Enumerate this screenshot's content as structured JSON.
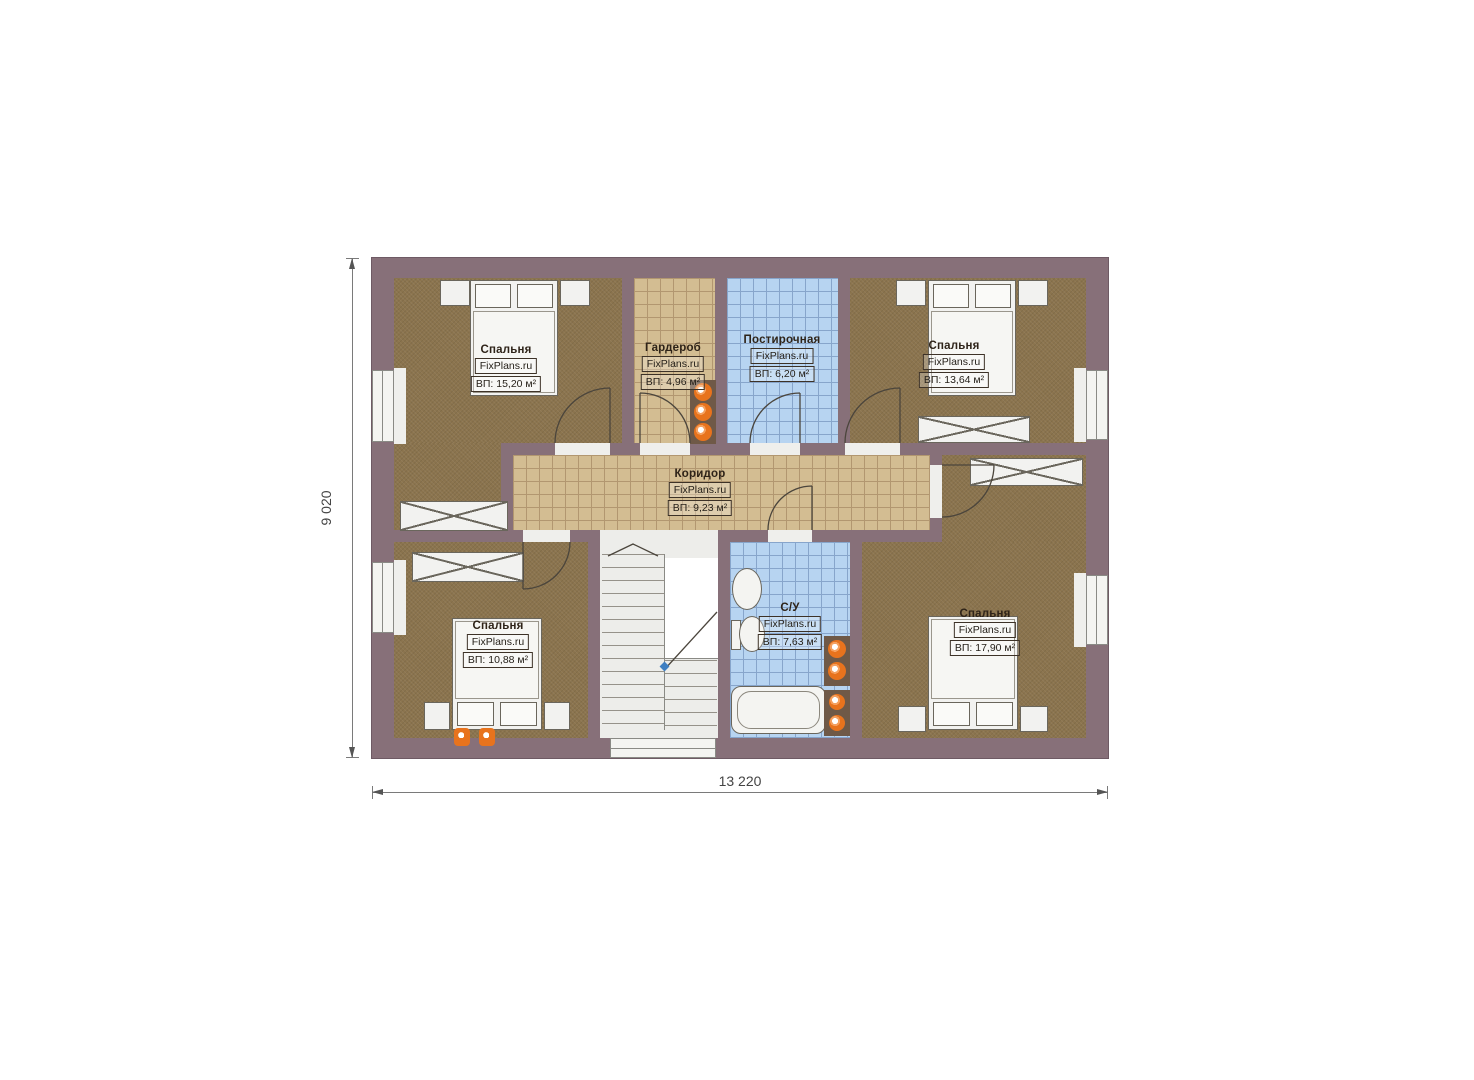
{
  "plan": {
    "watermark": "FixPlans.ru",
    "dimensions": {
      "width": "13 220",
      "height": "9 020"
    },
    "rooms": [
      {
        "key": "bedroom-top-left",
        "name": "Спальня",
        "area": "ВП: 15,20 м²"
      },
      {
        "key": "wardrobe",
        "name": "Гардероб",
        "area": "ВП: 4,96 м²"
      },
      {
        "key": "laundry",
        "name": "Постирочная",
        "area": "ВП: 6,20 м²"
      },
      {
        "key": "bedroom-top-right",
        "name": "Спальня",
        "area": "ВП: 13,64 м²"
      },
      {
        "key": "corridor",
        "name": "Коридор",
        "area": "ВП: 9,23 м²"
      },
      {
        "key": "bedroom-bottom-left",
        "name": "Спальня",
        "area": "ВП: 10,88 м²"
      },
      {
        "key": "bathroom",
        "name": "С/У",
        "area": "ВП: 7,63 м²"
      },
      {
        "key": "bedroom-bottom-right",
        "name": "Спальня",
        "area": "ВП: 17,90 м²"
      }
    ],
    "colors": {
      "wall": "#877079",
      "bedroom_floor": "#8b744e",
      "corridor_tile": "#d3bd92",
      "wet_room_tile": "#b7d4f1",
      "furniture": "#f2f2f0",
      "appliance_accent": "#e8731d"
    }
  }
}
